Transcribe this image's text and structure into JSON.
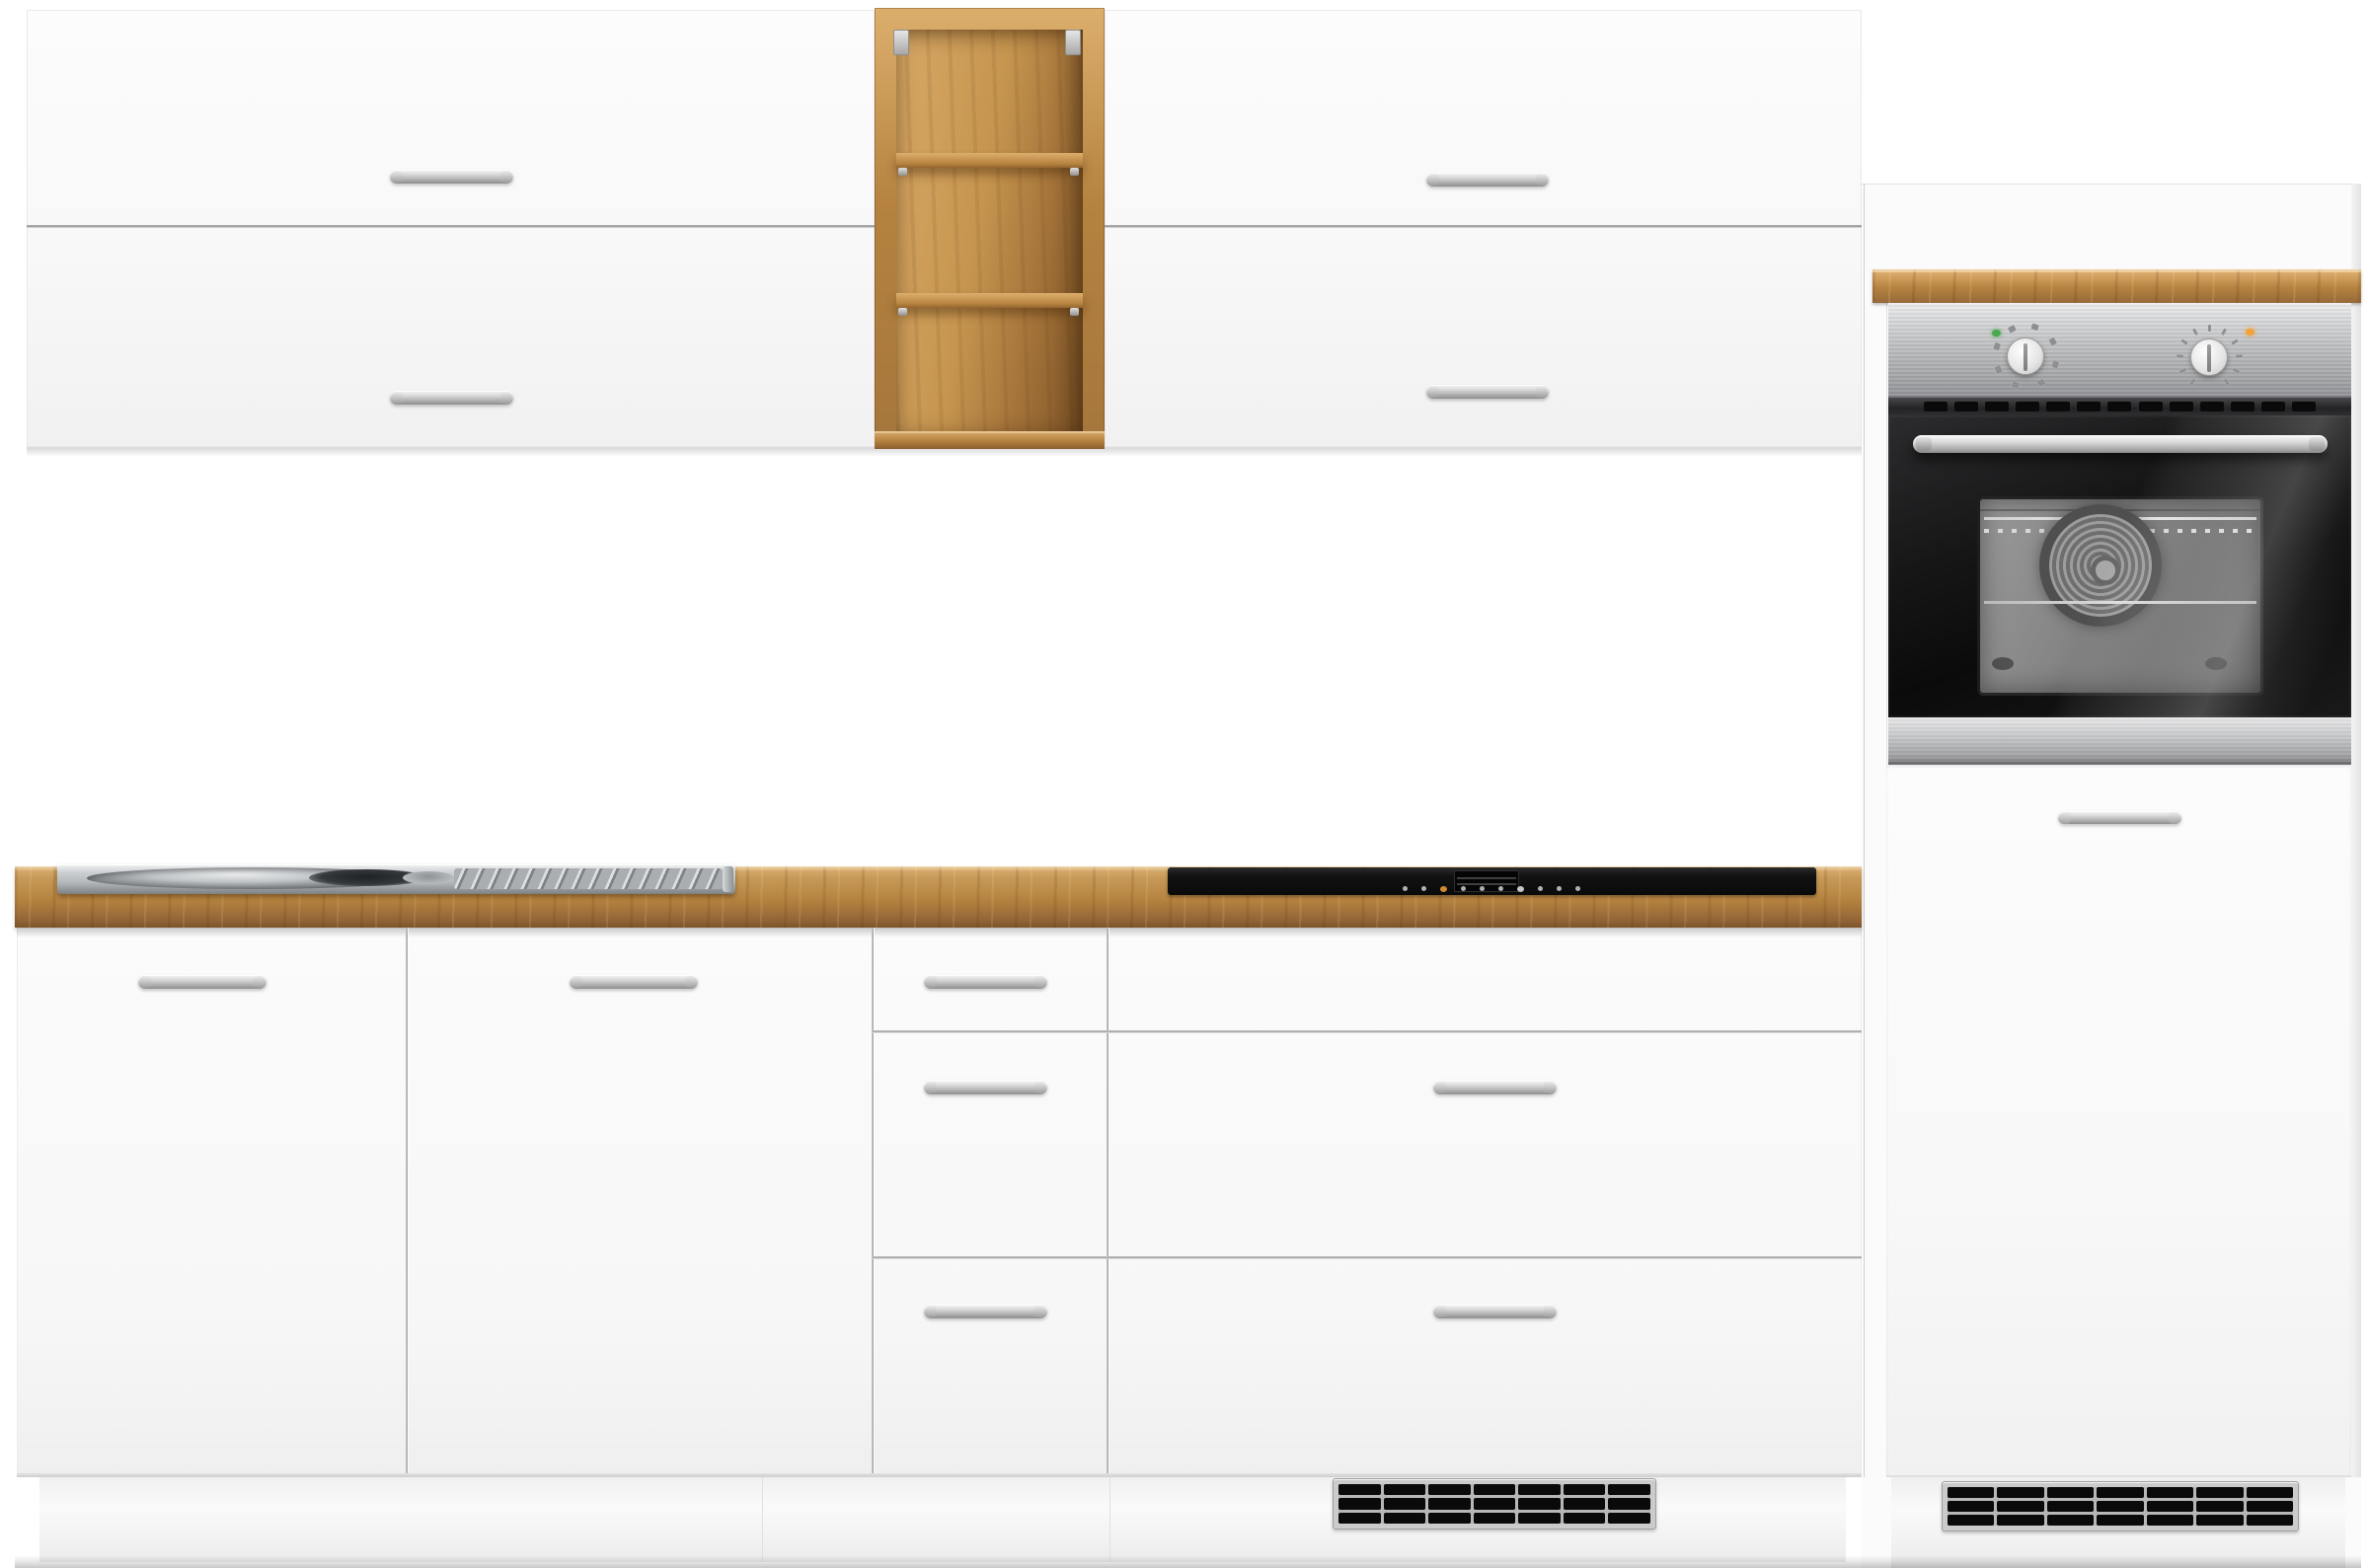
{
  "scene": {
    "type": "product-photo",
    "subject": "White kitchen cabinet set with oak-look open shelf, worktop, stainless sink, black cooktop and built-in oven",
    "background": "plain white studio background",
    "text_visible": false
  },
  "labels": {
    "stage": "kitchen furniture set product photo",
    "wall_cabinet_left": "left wall cabinet with two lift-up doors",
    "wall_cabinet_right": "right wall cabinet with two lift-up doors",
    "open_shelf": "open wall shelf in oak look with two shelves",
    "tall_unit": "tall oven housing unit",
    "control_panel": "stainless steel oven control panel",
    "knob_function": "oven function knob",
    "knob_temp": "oven temperature knob",
    "indicator_green": "green power indicator light",
    "indicator_orange": "orange heating indicator light",
    "oven": "built-in oven with black glass door",
    "oven_handle": "stainless oven door handle",
    "oven_window": "oven door window showing convection fan",
    "countertop": "oak-look worktop",
    "sink": "stainless steel inset sink with drainboard",
    "cooktop": "black glass cooktop with integrated vent",
    "base_cabinets": "base cabinets with doors and drawers",
    "grille": "black ventilation grille in plinth",
    "handle": "silver bar handle",
    "plinth": "white plinth panel",
    "floor_shadow": "floor contact shadow"
  },
  "colors": {
    "bg": "#ffffff",
    "door_white": "#fcfcfc",
    "door_low": "#f1f1f1",
    "cab_border": "#e9e9e9",
    "seam_dark": "#9c9c9c",
    "seam_light": "#c9c9c9",
    "handle_hi": "#f7f7f7",
    "handle_mid": "#bdbdbd",
    "handle_low": "#8e8e8e",
    "wood_hi": "#dcae6c",
    "wood_mid": "#b5823f",
    "wood_low": "#8a5f30",
    "steel_hi": "#efeff0",
    "steel_mid": "#c0c1c3",
    "steel_low": "#94959a",
    "window_hi": "#9a9a9a",
    "window_mid": "#6b6b6b",
    "window_low": "#585858",
    "fan_dark": "#4f4f4f",
    "indicator_green": "#49a94f",
    "indicator_orange": "#f2a23a",
    "cook_black": "#121212",
    "grille_frame": "#cbcbcb",
    "grille_bed": "#b7b7b7",
    "slot_black": "#0a0a0a",
    "sink_hi": "#f0f2f3",
    "sink_mid": "#b5b9bc",
    "sink_low": "#7e8285",
    "basin_dark": "#34383b"
  },
  "counts": {
    "shelf_compartments": 3,
    "wall_handle_count": 4,
    "base_handle_count": 7,
    "oven_vent_slots": 13,
    "grille_cells": 21,
    "grille_rows": 3,
    "grille_cols": 7,
    "cooktop_dots": 10
  },
  "radial": {
    "function_marks": {
      "count": 8,
      "radius": 31,
      "start": -160,
      "end": 150,
      "w": 7,
      "h": 6
    },
    "temp_ticks": {
      "count": 11,
      "radius": 30,
      "start": -145,
      "end": 145,
      "w": 3,
      "h": 7
    }
  }
}
